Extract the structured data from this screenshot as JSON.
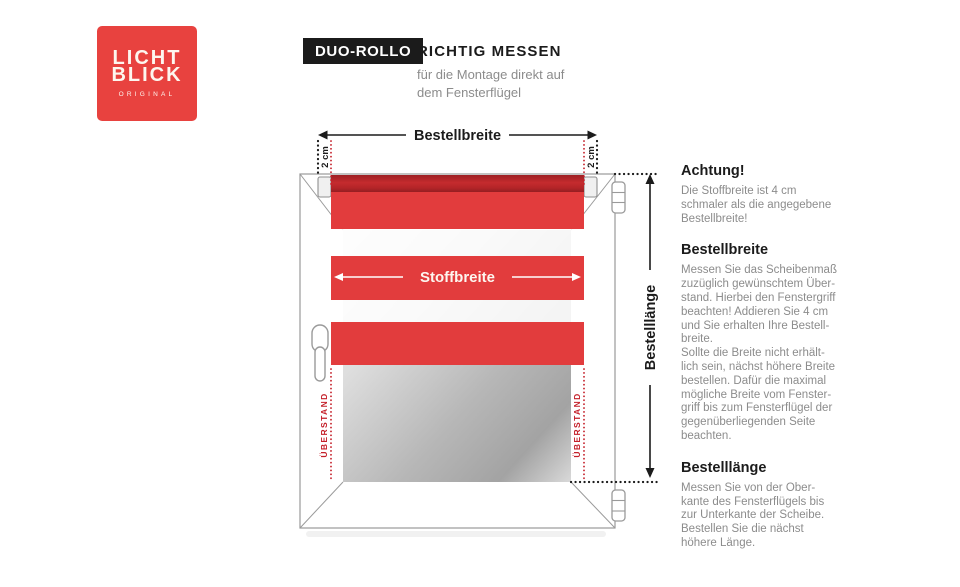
{
  "logo": {
    "word1": "LICHT",
    "word2": "BLICK",
    "tagline": "ORIGINAL"
  },
  "header": {
    "badge": "DUO-ROLLO",
    "title": "RICHTIG MESSEN",
    "subtitle": "für die Montage direkt auf\ndem Fensterflügel"
  },
  "diagram": {
    "order_width_label": "Bestellbreite",
    "fabric_width_label": "Stoffbreite",
    "order_length_label": "Bestelllänge",
    "offset_left_label": "2 cm",
    "offset_right_label": "2 cm",
    "overhang_left_label": "ÜBERSTAND",
    "overhang_right_label": "ÜBERSTAND",
    "colors": {
      "fabric_red": "#e23c3d",
      "cassette_red": "#b02428",
      "marker_red": "#c4202a",
      "logo_red": "#e8423f",
      "ink": "#1b1b1b",
      "body_gray": "#8c8c8c"
    }
  },
  "info_sections": [
    {
      "heading": "Achtung!",
      "body": "Die Stoffbreite ist 4 cm\nschmaler als die angegebene\nBestellbreite!"
    },
    {
      "heading": "Bestellbreite",
      "body": "Messen Sie das Scheibenmaß\nzuzüglich gewünschtem Über-\nstand. Hierbei den Fenstergriff\nbeachten! Addieren Sie 4 cm\nund Sie erhalten Ihre Bestell-\nbreite.\nSollte die Breite nicht erhält-\nlich sein, nächst höhere Breite\nbestellen. Dafür die maximal\nmögliche Breite vom Fenster-\ngriff bis zum Fensterflügel der\ngegenüberliegenden Seite\nbeachten."
    },
    {
      "heading": "Bestelllänge",
      "body": "Messen Sie von der Ober-\nkante des Fensterflügels bis\nzur Unterkante der Scheibe.\nBestellen Sie die nächst\nhöhere Länge."
    }
  ]
}
